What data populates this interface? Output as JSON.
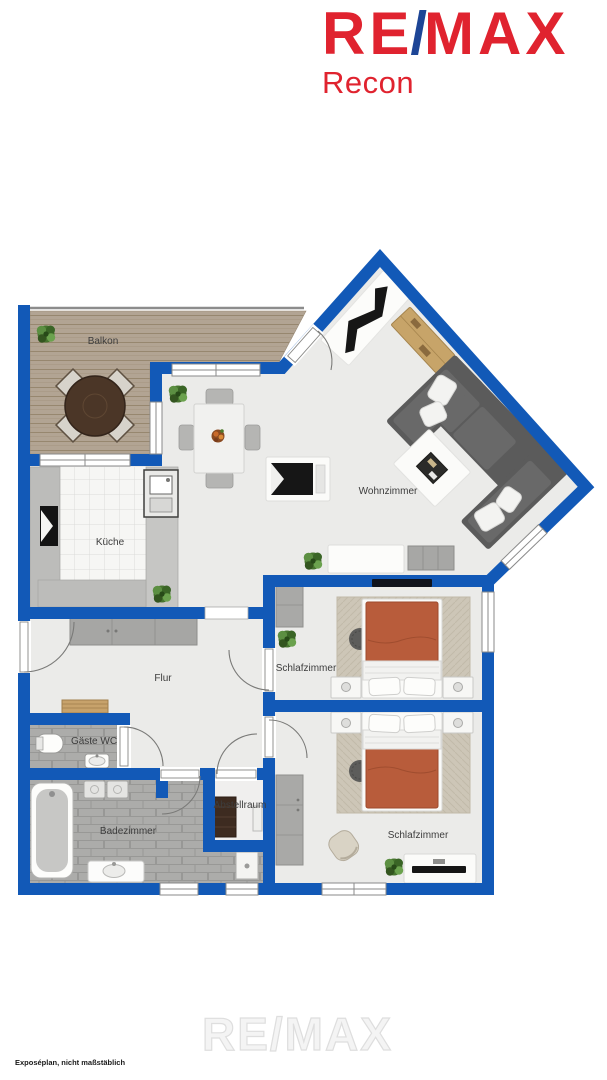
{
  "brand": {
    "wordmark_re": "RE",
    "wordmark_slash": "/",
    "wordmark_max": "MAX",
    "office_name": "Recon"
  },
  "floorplan": {
    "type": "apartment-floor-plan",
    "rooms": {
      "balcony": {
        "label": "Balkon"
      },
      "living_room": {
        "label": "Wohnzimmer"
      },
      "kitchen": {
        "label": "Küche"
      },
      "hallway": {
        "label": "Flur"
      },
      "guest_wc": {
        "label": "Gäste WC"
      },
      "bathroom": {
        "label": "Badezimmer"
      },
      "storage": {
        "label": "Abstellraum"
      },
      "bedroom_1": {
        "label": "Schlafzimmer"
      },
      "bedroom_2": {
        "label": "Schlafzimmer"
      }
    },
    "colors": {
      "wall_blue": "#1259b7",
      "brand_red": "#e0232f",
      "brand_blue": "#1d4596",
      "floor_gray": "#ebebe9",
      "deck_wood": "#b2a493",
      "bed_cover_terracotta": "#b85c3b",
      "sofa_gray": "#5b5b5b"
    }
  },
  "footer": {
    "disclaimer": "Exposéplan, nicht maßstäblich",
    "watermark": "RE/MAX"
  }
}
